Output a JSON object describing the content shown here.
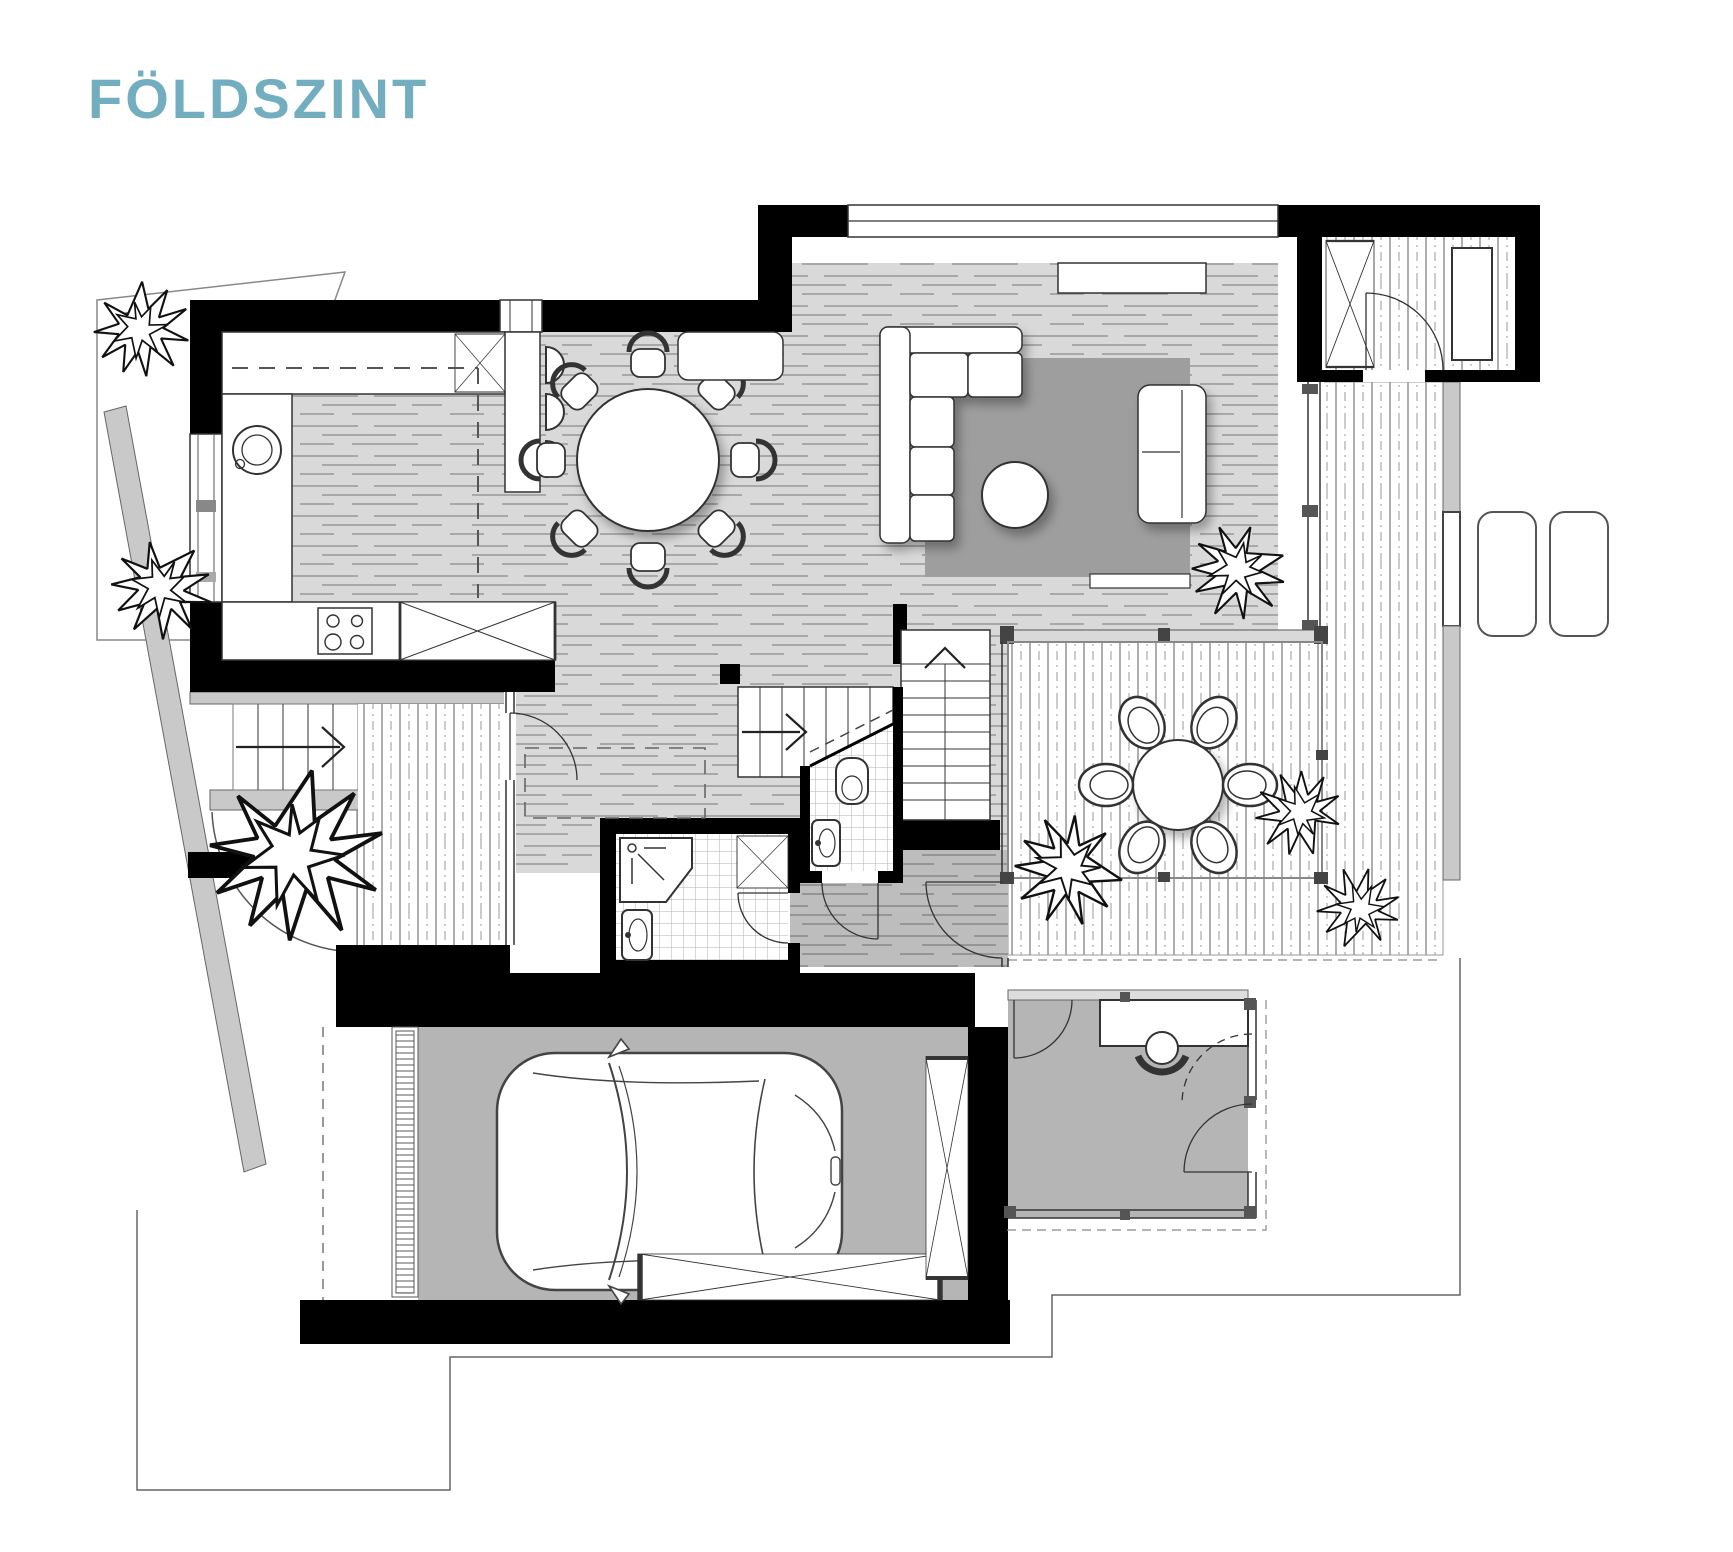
{
  "title": {
    "text": "FÖLDSZINT",
    "color": "#72adc0"
  },
  "plan": {
    "kind": "architectural floor plan, top view, black walls on white",
    "colors": {
      "walls": "#000000",
      "interior_wood_floor": "#d9d9d9",
      "hall_wood_floor": "#bdbdbd",
      "garage_floor": "#b5b5b5",
      "rug": "#9e9e9e",
      "deck_plank_line": "#777777",
      "tile_line": "#b0b0b0",
      "site_gray": "#c9c9c9"
    }
  }
}
